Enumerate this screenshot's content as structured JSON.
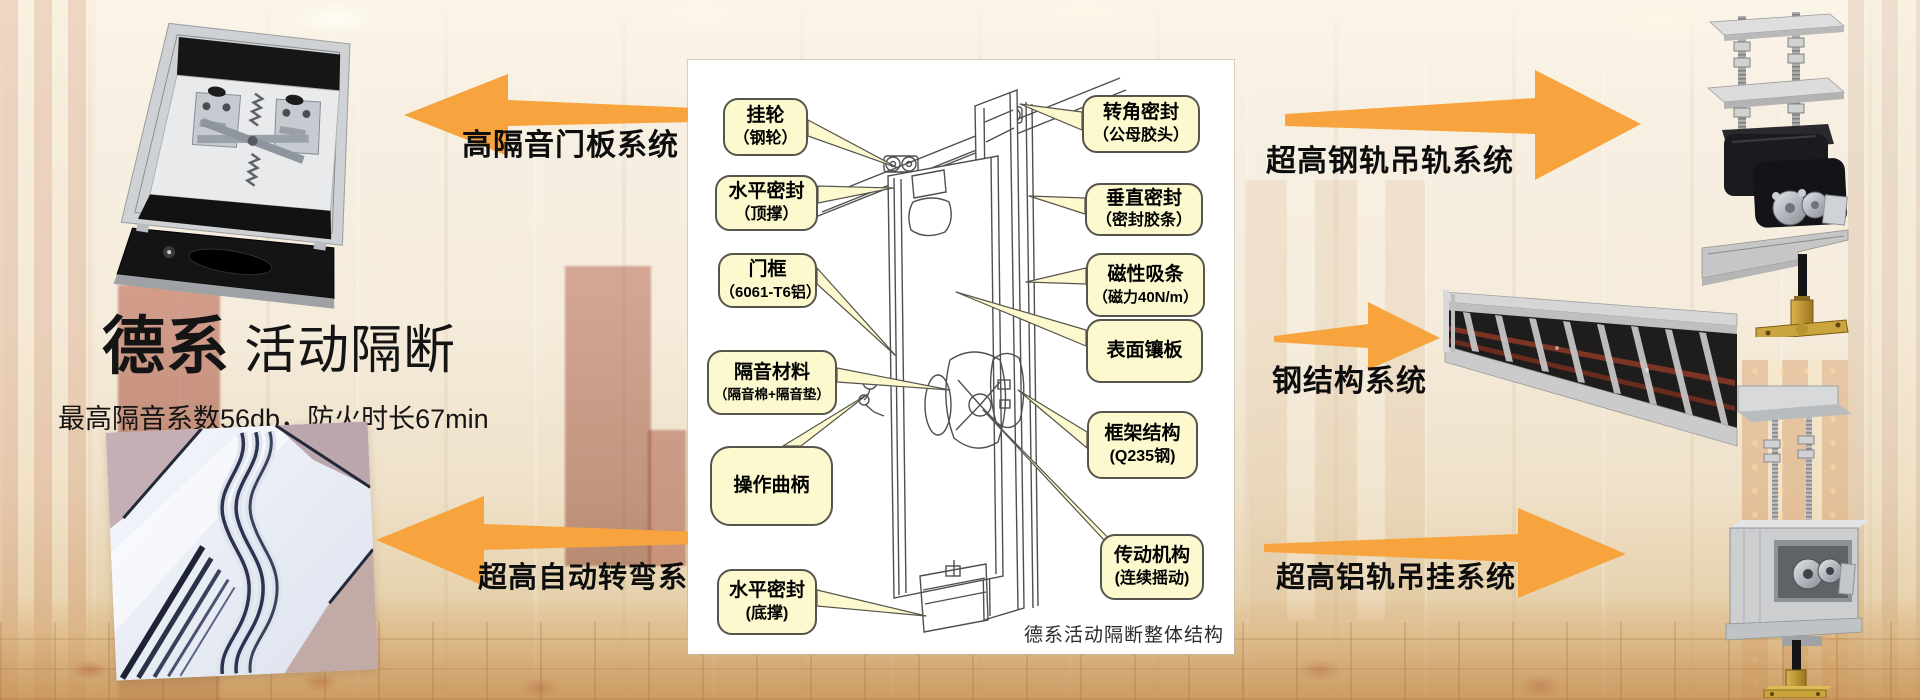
{
  "page": {
    "title_brand": "德系",
    "title_product": "活动隔断",
    "subtitle": "最高隔音系数56db，防火时长67min"
  },
  "systems": {
    "left_top": "高隔音门板系统",
    "left_bottom": "超高自动转弯系统",
    "right_top": "超高钢轨吊轨系统",
    "right_middle": "钢结构系统",
    "right_bottom": "超高铝轨吊挂系统"
  },
  "diagram": {
    "caption": "德系活动隔断整体结构",
    "callouts_left": [
      {
        "line1": "挂轮",
        "line2": "（钢轮）"
      },
      {
        "line1": "水平密封",
        "line2": "（顶撑）"
      },
      {
        "line1": "门框",
        "line2": "（6061-T6铝）"
      },
      {
        "line1": "隔音材料",
        "line2": "（隔音棉+隔音垫）"
      },
      {
        "line1": "操作曲柄",
        "line2": ""
      },
      {
        "line1": "水平密封",
        "line2": "(底撑)"
      }
    ],
    "callouts_right": [
      {
        "line1": "转角密封",
        "line2": "（公母胶头）"
      },
      {
        "line1": "垂直密封",
        "line2": "（密封胶条）"
      },
      {
        "line1": "磁性吸条",
        "line2": "（磁力40N/m）"
      },
      {
        "line1": "表面镶板",
        "line2": ""
      },
      {
        "line1": "框架结构",
        "line2": "(Q235钢)"
      },
      {
        "line1": "传动机构",
        "line2": "(连续摇动)"
      }
    ]
  },
  "colors": {
    "arrow": "#F8A43E",
    "callout_fill": "#FCF9CF",
    "callout_border": "#57554B"
  }
}
